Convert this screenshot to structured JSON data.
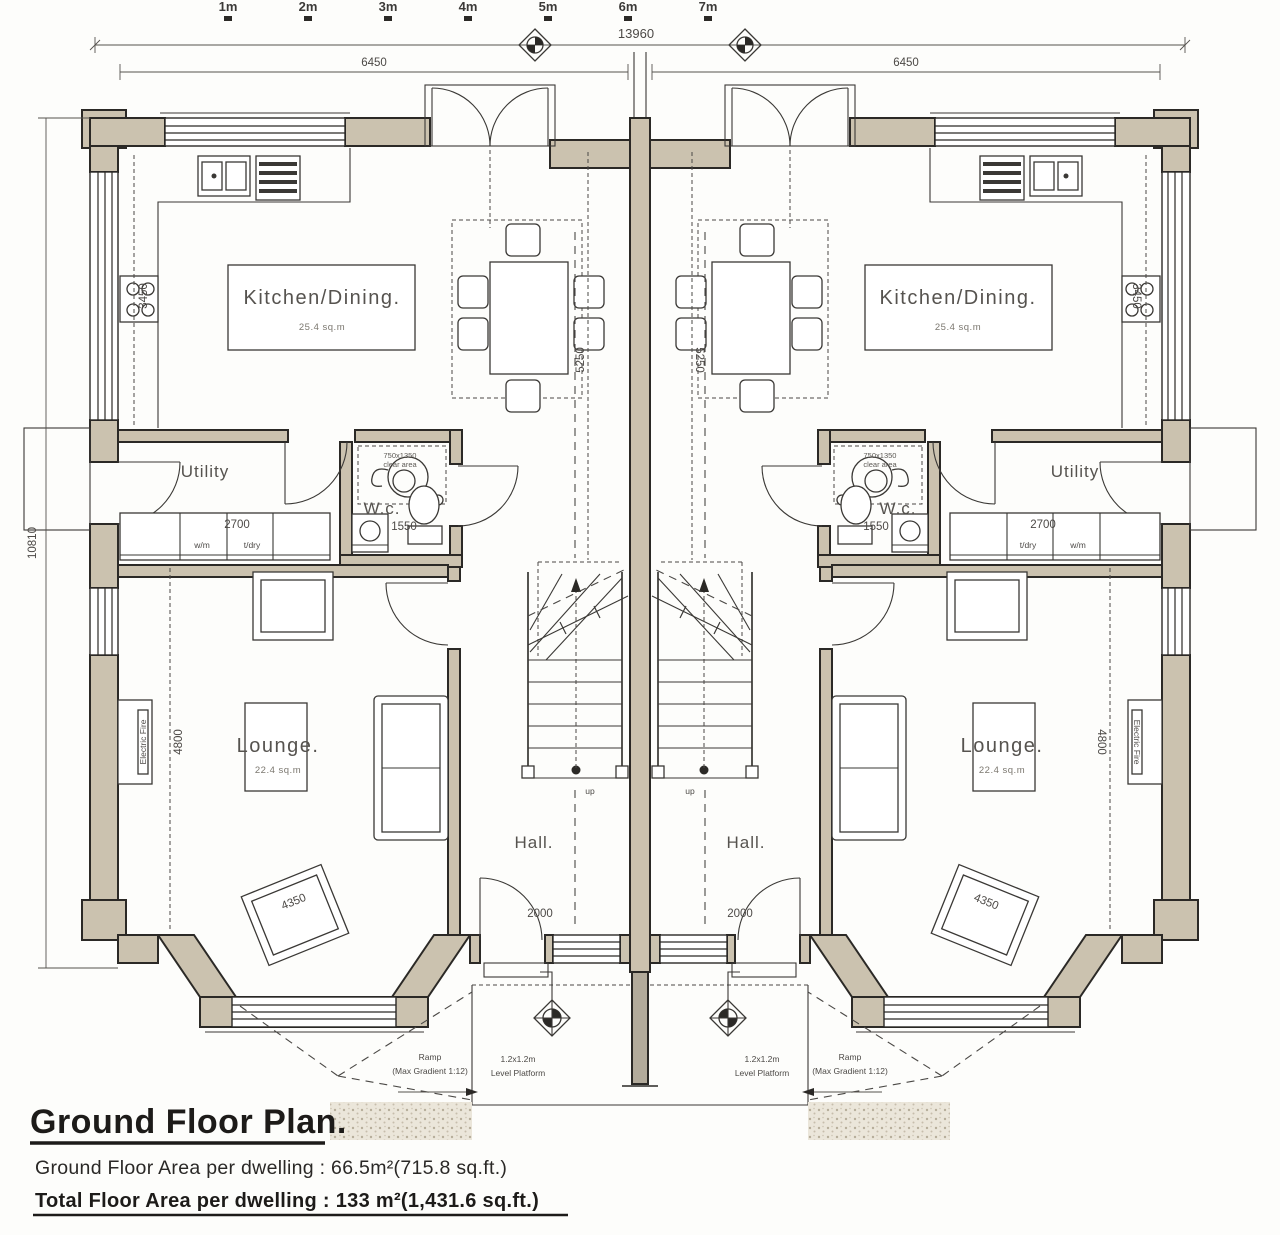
{
  "colors": {
    "paper": "#fdfdfb",
    "wall_fill": "#cbc2af",
    "line": "#2b2926",
    "text": "#56534f"
  },
  "scale_bar": {
    "ticks": [
      "1m",
      "2m",
      "3m",
      "4m",
      "5m",
      "6m",
      "7m"
    ]
  },
  "dimensions": {
    "overall_width": "13960",
    "dwelling_width": "6450",
    "overall_depth": "10810",
    "kitchen_depth": "3450",
    "kitchen_width": "5250",
    "lounge_depth": "4800",
    "utility_run": "2700",
    "wc_width": "1550",
    "hall_door": "2000",
    "lounge_rug": "4350"
  },
  "rooms": {
    "kitchen": {
      "name": "Kitchen/Dining.",
      "area": "25.4 sq.m"
    },
    "utility": {
      "name": "Utility"
    },
    "wc": {
      "name": "W.c."
    },
    "lounge": {
      "name": "Lounge.",
      "area": "22.4 sq.m"
    },
    "hall": {
      "name": "Hall."
    }
  },
  "annotations": {
    "electric_fire": "Electric Fire",
    "washing_machine": "w/m",
    "tumble_dryer": "t/dry",
    "stairs_up": "up",
    "wc_clear_line1": "750x1350",
    "wc_clear_line2": "clear area",
    "ramp_line1": "Ramp",
    "ramp_line2": "(Max Gradient 1:12)",
    "platform_line1": "1.2x1.2m",
    "platform_line2": "Level Platform"
  },
  "title_block": {
    "title": "Ground Floor Plan.",
    "area_line": "Ground Floor Area per dwelling : 66.5m²(715.8 sq.ft.)",
    "total_line": "Total Floor Area per dwelling : 133 m²(1,431.6 sq.ft.)"
  }
}
